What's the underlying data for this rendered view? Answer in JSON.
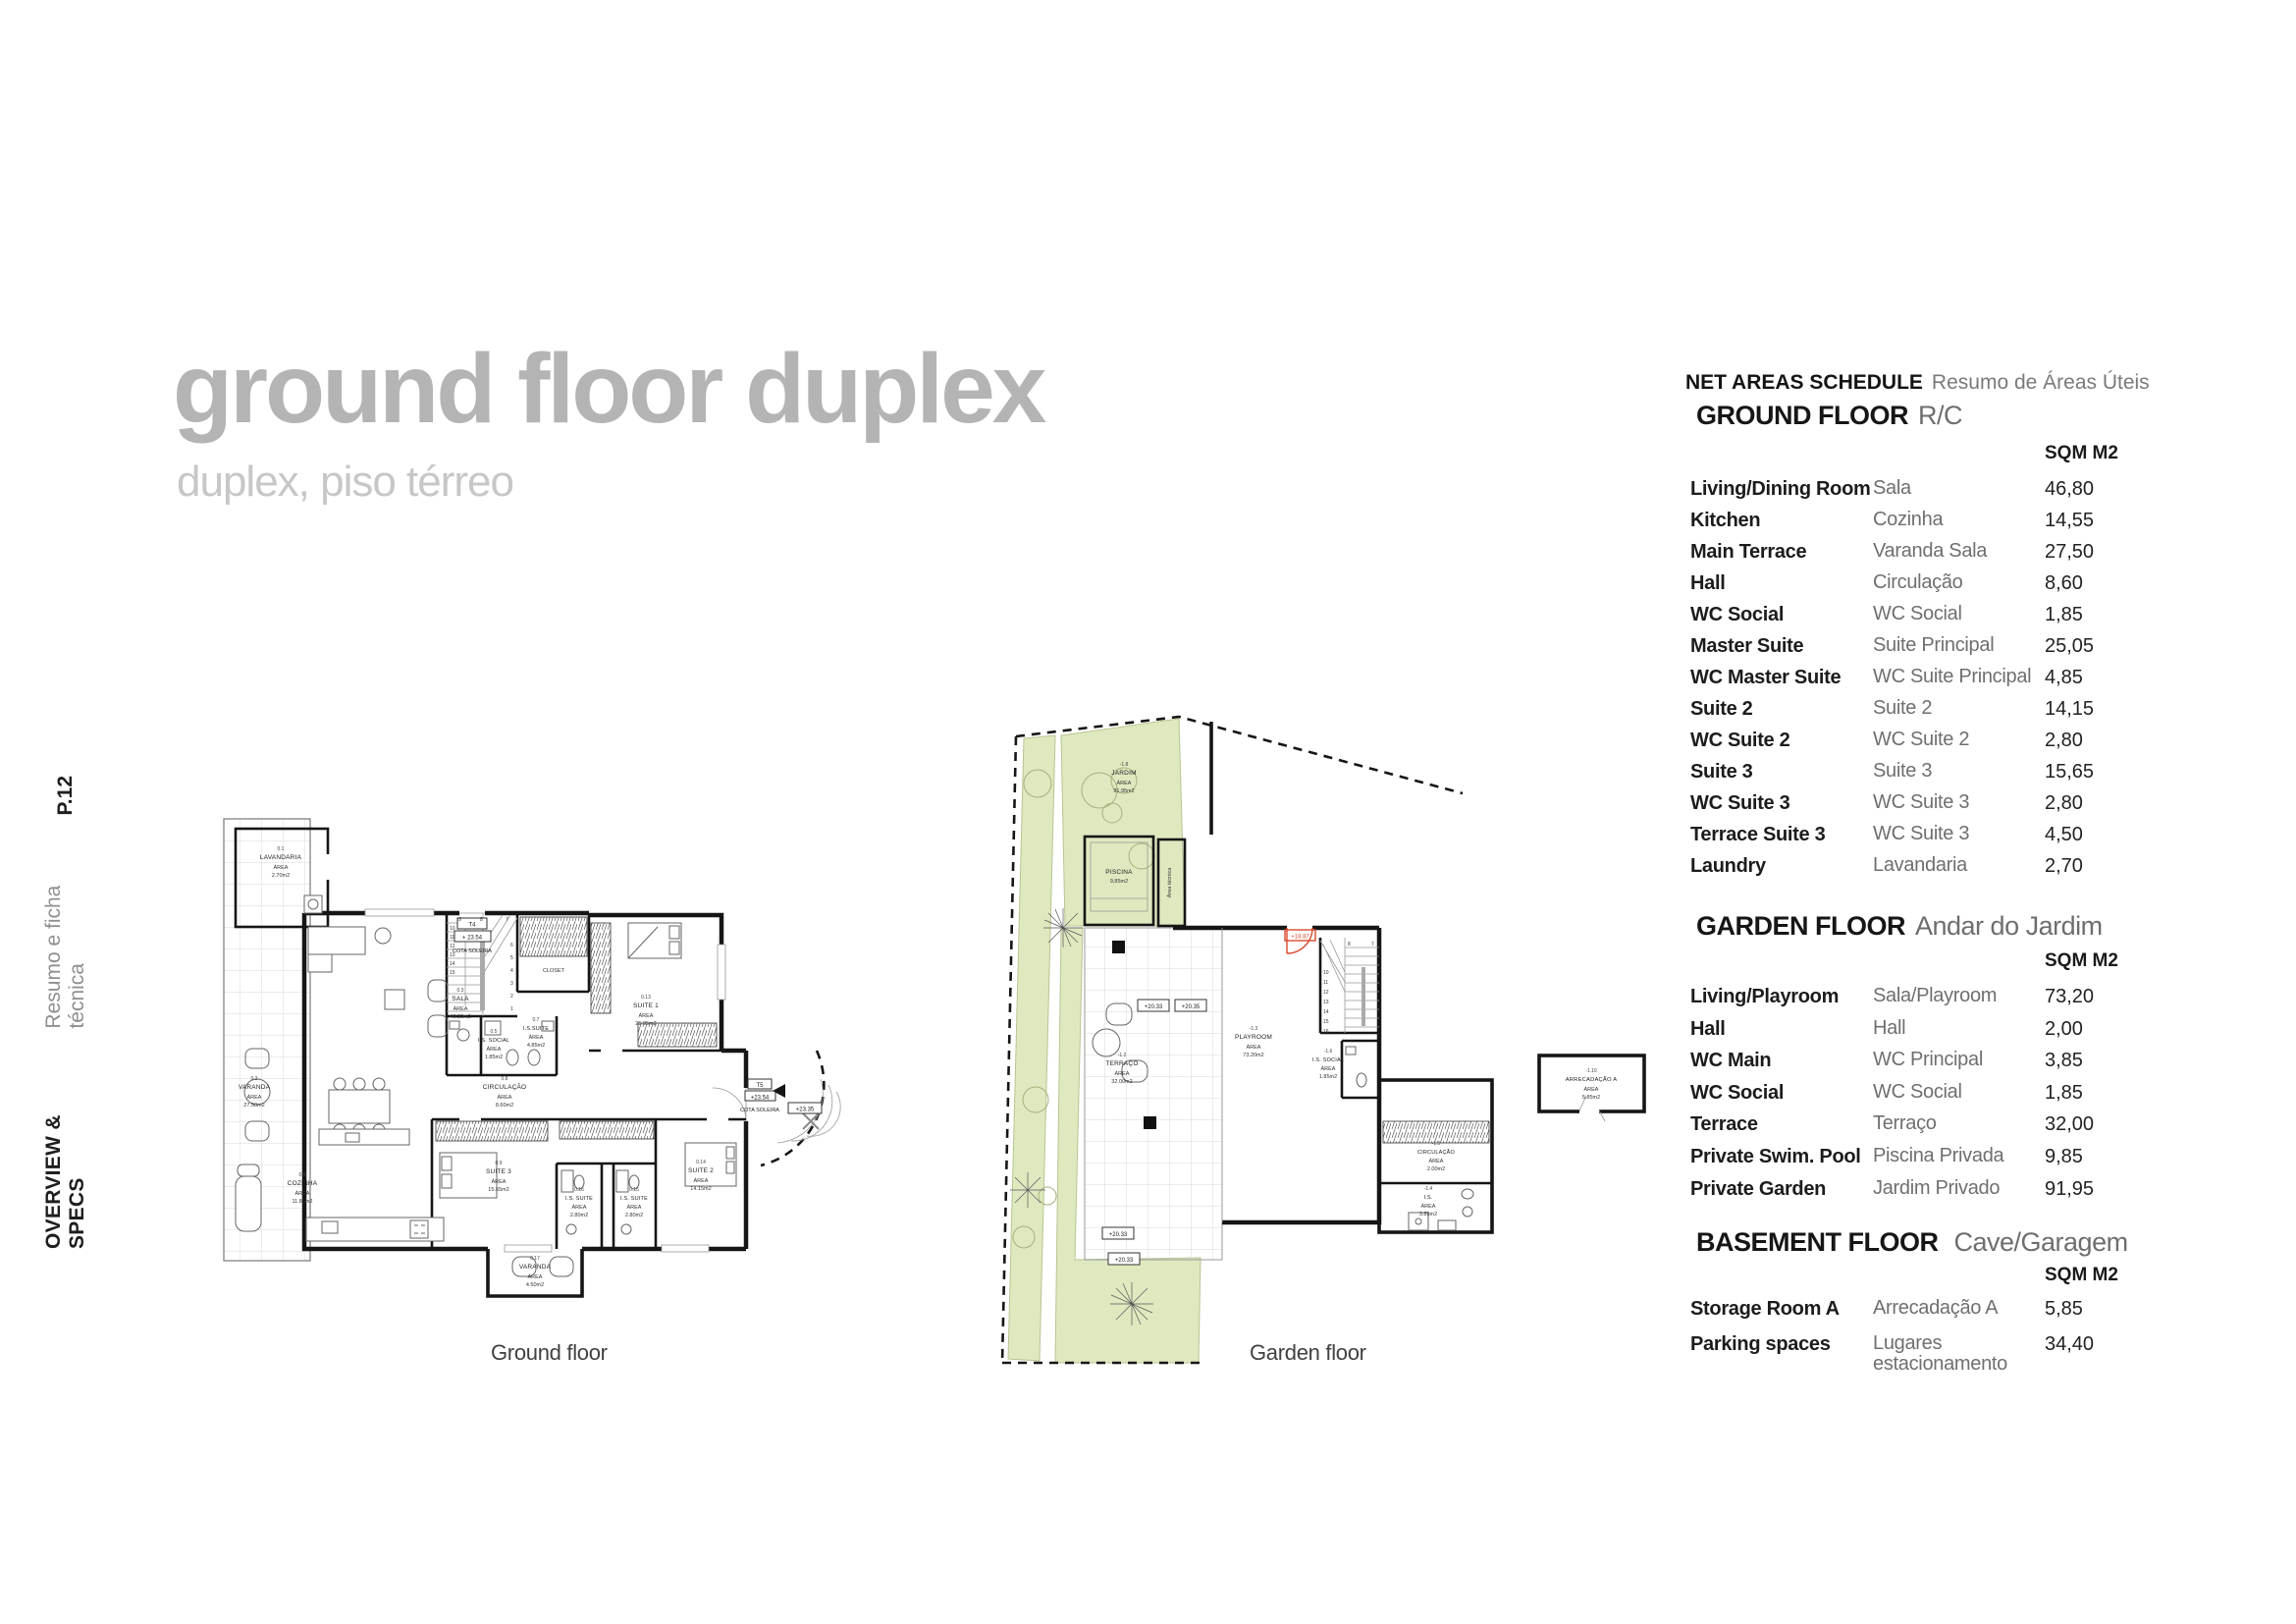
{
  "page": {
    "number": "P.12",
    "section_en": "OVERVIEW & SPECS",
    "section_pt": "Resumo e ficha técnica"
  },
  "title": {
    "main": "ground floor duplex",
    "subtitle": "duplex, piso térreo"
  },
  "schedule": {
    "header_en": "NET AREAS SCHEDULE",
    "header_pt": "Resumo de Áreas Úteis",
    "unit": "SQM M2",
    "sections": [
      {
        "heading_en": "GROUND FLOOR",
        "heading_pt": "R/C",
        "rows": [
          {
            "en": "Living/Dining Room",
            "pt": "Sala",
            "sqm": "46,80"
          },
          {
            "en": "Kitchen",
            "pt": "Cozinha",
            "sqm": "14,55"
          },
          {
            "en": "Main Terrace",
            "pt": "Varanda Sala",
            "sqm": "27,50"
          },
          {
            "en": "Hall",
            "pt": "Circulação",
            "sqm": "8,60"
          },
          {
            "en": "WC Social",
            "pt": "WC Social",
            "sqm": "1,85"
          },
          {
            "en": "Master Suite",
            "pt": "Suite Principal",
            "sqm": "25,05"
          },
          {
            "en": "WC Master Suite",
            "pt": "WC Suite Principal",
            "sqm": "4,85"
          },
          {
            "en": "Suite 2",
            "pt": "Suite 2",
            "sqm": "14,15"
          },
          {
            "en": "WC Suite 2",
            "pt": "WC Suite 2",
            "sqm": "2,80"
          },
          {
            "en": "Suite 3",
            "pt": "Suite 3",
            "sqm": "15,65"
          },
          {
            "en": "WC Suite 3",
            "pt": "WC Suite 3",
            "sqm": "2,80"
          },
          {
            "en": "Terrace Suite 3",
            "pt": "WC Suite 3",
            "sqm": "4,50"
          },
          {
            "en": "Laundry",
            "pt": "Lavandaria",
            "sqm": "2,70"
          }
        ]
      },
      {
        "heading_en": "GARDEN FLOOR",
        "heading_pt": "Andar do Jardim",
        "rows": [
          {
            "en": "Living/Playroom",
            "pt": "Sala/Playroom",
            "sqm": "73,20"
          },
          {
            "en": "Hall",
            "pt": "Hall",
            "sqm": "2,00"
          },
          {
            "en": "WC Main",
            "pt": "WC Principal",
            "sqm": "3,85"
          },
          {
            "en": "WC Social",
            "pt": "WC Social",
            "sqm": "1,85"
          },
          {
            "en": "Terrace",
            "pt": "Terraço",
            "sqm": "32,00"
          },
          {
            "en": "Private Swim. Pool",
            "pt": "Piscina Privada",
            "sqm": "9,85"
          },
          {
            "en": "Private Garden",
            "pt": "Jardim Privado",
            "sqm": "91,95"
          }
        ]
      },
      {
        "heading_en": "BASEMENT FLOOR",
        "heading_pt": "Cave/Garagem",
        "rows": [
          {
            "en": "Storage Room A",
            "pt": "Arrecadação A",
            "sqm": "5,85"
          },
          {
            "en": "Parking spaces",
            "pt": "Lugares estacionamento",
            "sqm": "34,40"
          }
        ]
      }
    ]
  },
  "plans": {
    "area_word": "ÁREA",
    "ground": {
      "caption": "Ground floor",
      "rooms": [
        {
          "num": "0.1",
          "name": "LAVANDARIA",
          "area": "2.70m2"
        },
        {
          "num": "0.2",
          "name": "VARANDA",
          "area": "27.50m2"
        },
        {
          "num": "0.3",
          "name": "SALA",
          "area": "46.80m2"
        },
        {
          "num": "0.4",
          "name": "COZINHA",
          "area": "11.85m2"
        },
        {
          "num": "0.5",
          "name": "I.S. SOCIAL",
          "area": "1.85m2"
        },
        {
          "num": "0.7",
          "name": "I.S.SUITE",
          "area": "4.85m2"
        },
        {
          "num": "0.8",
          "name": "CIRCULAÇÃO",
          "area": "8.60m2"
        },
        {
          "num": "0.9",
          "name": "SUITE 3",
          "area": "15.65m2"
        },
        {
          "num": "0.13",
          "name": "SUITE 1",
          "area": "25.05m2"
        },
        {
          "num": "0.14",
          "name": "SUITE 2",
          "area": "14.15m2"
        },
        {
          "num": "0.15",
          "name": "I.S. SUITE",
          "area": "2.80m2"
        },
        {
          "num": "0.16",
          "name": "I.S. SUITE",
          "area": "2.80m2"
        },
        {
          "num": "0.17",
          "name": "VARANDA",
          "area": "4.50m2"
        },
        {
          "name": "CLOSET"
        }
      ],
      "markers": {
        "t4": "T4",
        "t4_level": "+ 23.54",
        "cota": "COTA SOLEIRA",
        "t5": "T5",
        "t5_level": "+23.54",
        "level_235": "+23.35"
      },
      "stair_numbers": [
        "10",
        "11",
        "12",
        "13",
        "14",
        "15",
        "9",
        "8",
        "7",
        "6",
        "5",
        "4",
        "3",
        "2",
        "1"
      ]
    },
    "garden": {
      "caption": "Garden floor",
      "rooms": [
        {
          "num": "-1.8",
          "name": "JARDIM",
          "area": "91.95m2"
        },
        {
          "name": "PISCINA",
          "area": "9,85m2"
        },
        {
          "num": "-1.2",
          "name": "TERRAÇO",
          "area": "32.00m2"
        },
        {
          "num": "-1.3",
          "name": "PLAYROOM",
          "area": "73.20m2"
        },
        {
          "num": "-1.6",
          "name": "I.S. SOCIAL",
          "area": "1.85m2"
        },
        {
          "num": "-1.5",
          "name": "CIRCULAÇÃO",
          "area": "2.00m2"
        },
        {
          "num": "-1.4",
          "name": "I.S.",
          "area": "3.85m2"
        },
        {
          "num": "-1.10",
          "name": "ARRECADAÇÃO A",
          "area": "5.85m2"
        },
        {
          "name": "Área técnica"
        }
      ],
      "markers": {
        "m2033": "+20.33",
        "m2035": "+20.35",
        "m1887": "+18.87"
      },
      "stair_numbers": [
        "10",
        "11",
        "12",
        "13",
        "14",
        "15",
        "16",
        "8",
        "7"
      ]
    }
  }
}
